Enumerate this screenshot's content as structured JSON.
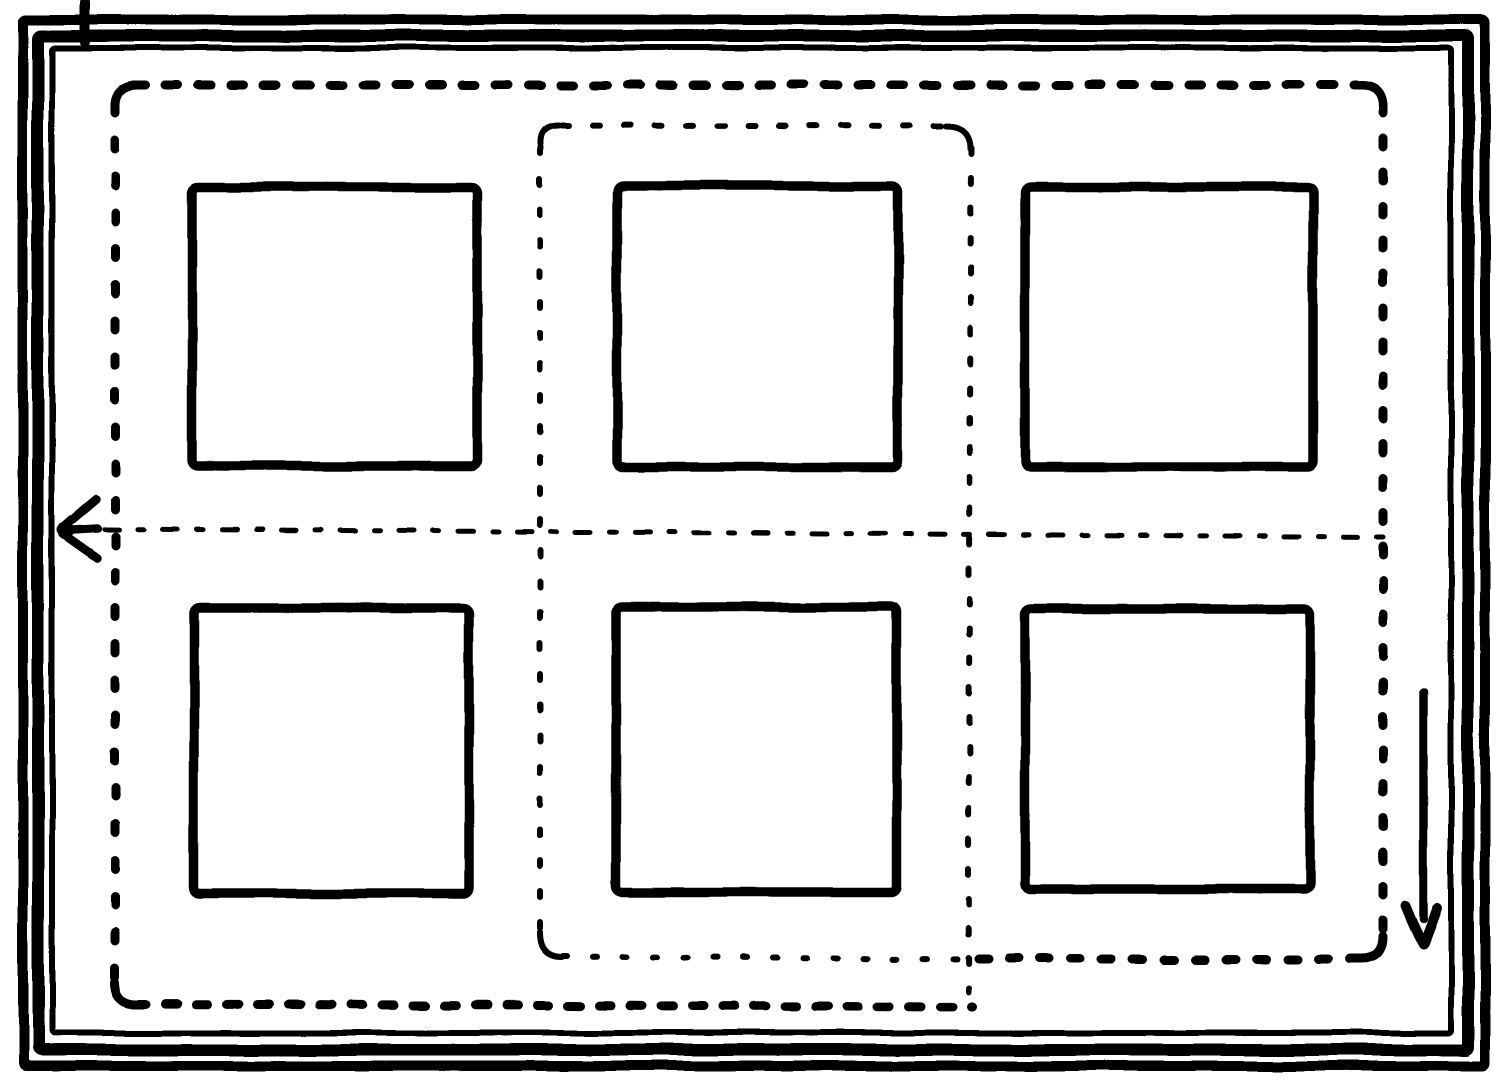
{
  "meta": {
    "width": 1500,
    "height": 1081,
    "background": "#ffffff",
    "ink": "#000000"
  },
  "frames": [
    {
      "id": "outermost",
      "x": 23,
      "y": 20,
      "w": 1462,
      "h": 1046,
      "stroke": 10
    },
    {
      "id": "middle",
      "x": 38,
      "y": 36,
      "w": 1430,
      "h": 1014,
      "stroke": 12
    },
    {
      "id": "innermost",
      "x": 52,
      "y": 48,
      "w": 1399,
      "h": 985,
      "stroke": 6
    }
  ],
  "scan_artifacts": [
    {
      "id": "topleft-overshoot",
      "x1": 85,
      "y1": 2,
      "x2": 85,
      "y2": 42,
      "stroke": 10
    }
  ],
  "outer_dashed_boundary": {
    "stroke": 9,
    "edges": [
      {
        "id": "top",
        "x1": 132,
        "y1": 85,
        "x2": 1364,
        "y2": 85,
        "dash": "13 20"
      },
      {
        "id": "left",
        "x1": 115,
        "y1": 104,
        "x2": 115,
        "y2": 984,
        "dash": "9 27"
      },
      {
        "id": "right",
        "x1": 1383,
        "y1": 104,
        "x2": 1383,
        "y2": 940,
        "dash": "9 25"
      },
      {
        "id": "bottom-left-span",
        "x1": 134,
        "y1": 1004,
        "x2": 972,
        "y2": 1007,
        "dash": "12 19"
      },
      {
        "id": "bottom-right-span",
        "x1": 978,
        "y1": 959,
        "x2": 1366,
        "y2": 959,
        "dash": "10 21"
      }
    ],
    "corners": [
      {
        "id": "top-left",
        "d": "M 115 108 Q 114 85 137 85"
      },
      {
        "id": "top-right",
        "d": "M 1361 85 Q 1383 85 1383 107"
      },
      {
        "id": "bottom-left",
        "d": "M 115 982 Q 115 1004 138 1004"
      },
      {
        "id": "bottom-right",
        "d": "M 1383 936 Q 1383 959 1361 959"
      }
    ]
  },
  "inner_dashdot_boundary": {
    "stroke": 6,
    "edges": [
      {
        "id": "top",
        "x1": 562,
        "y1": 125,
        "x2": 948,
        "y2": 126,
        "dash": "7 24"
      },
      {
        "id": "left",
        "x1": 540,
        "y1": 147,
        "x2": 540,
        "y2": 934,
        "dash": "6 25"
      },
      {
        "id": "right",
        "x1": 971,
        "y1": 148,
        "x2": 968,
        "y2": 992,
        "dash": "6 24"
      },
      {
        "id": "bottom",
        "x1": 563,
        "y1": 956,
        "x2": 976,
        "y2": 959,
        "dash": "4 26"
      }
    ],
    "corners": [
      {
        "id": "top-left",
        "d": "M 540 144 Q 539 125 559 125"
      },
      {
        "id": "top-right",
        "d": "M 946 126 Q 970 126 970 149"
      },
      {
        "id": "bottom-left",
        "d": "M 540 932 Q 540 957 562 957"
      }
    ]
  },
  "aperture_squares": {
    "stroke": 9.5,
    "items": [
      {
        "row": 1,
        "col": 1,
        "x": 192,
        "y": 187,
        "w": 285,
        "h": 279
      },
      {
        "row": 1,
        "col": 2,
        "x": 617,
        "y": 186,
        "w": 281,
        "h": 281
      },
      {
        "row": 1,
        "col": 3,
        "x": 1025,
        "y": 187,
        "w": 288,
        "h": 280
      },
      {
        "row": 2,
        "col": 1,
        "x": 194,
        "y": 608,
        "w": 275,
        "h": 285
      },
      {
        "row": 2,
        "col": 2,
        "x": 616,
        "y": 607,
        "w": 281,
        "h": 285
      },
      {
        "row": 2,
        "col": 3,
        "x": 1025,
        "y": 609,
        "w": 285,
        "h": 280
      }
    ]
  },
  "center_scan_line": {
    "x1": 104,
    "y1": 529,
    "x2": 1383,
    "y2": 537,
    "stroke": 5,
    "dash": "15 19 6 19"
  },
  "arrows": {
    "left_crowfoot": {
      "stroke": 8.5,
      "tip": {
        "cx": 66,
        "cy": 530,
        "rx": 9,
        "ry": 7
      },
      "prongs": [
        {
          "id": "upper",
          "x1": 63,
          "y1": 527,
          "x2": 96,
          "y2": 499
        },
        {
          "id": "middle",
          "x1": 64,
          "y1": 530,
          "x2": 97,
          "y2": 528
        },
        {
          "id": "lower",
          "x1": 63,
          "y1": 534,
          "x2": 97,
          "y2": 558
        }
      ]
    },
    "down_arrow": {
      "shaft": {
        "x1": 1423,
        "y1": 692,
        "x2": 1423,
        "y2": 918,
        "stroke": 8.5
      },
      "head": {
        "d": "M 1405 905 Q 1416 932 1423 944 Q 1430 927 1437 907",
        "stroke": 10
      }
    }
  }
}
